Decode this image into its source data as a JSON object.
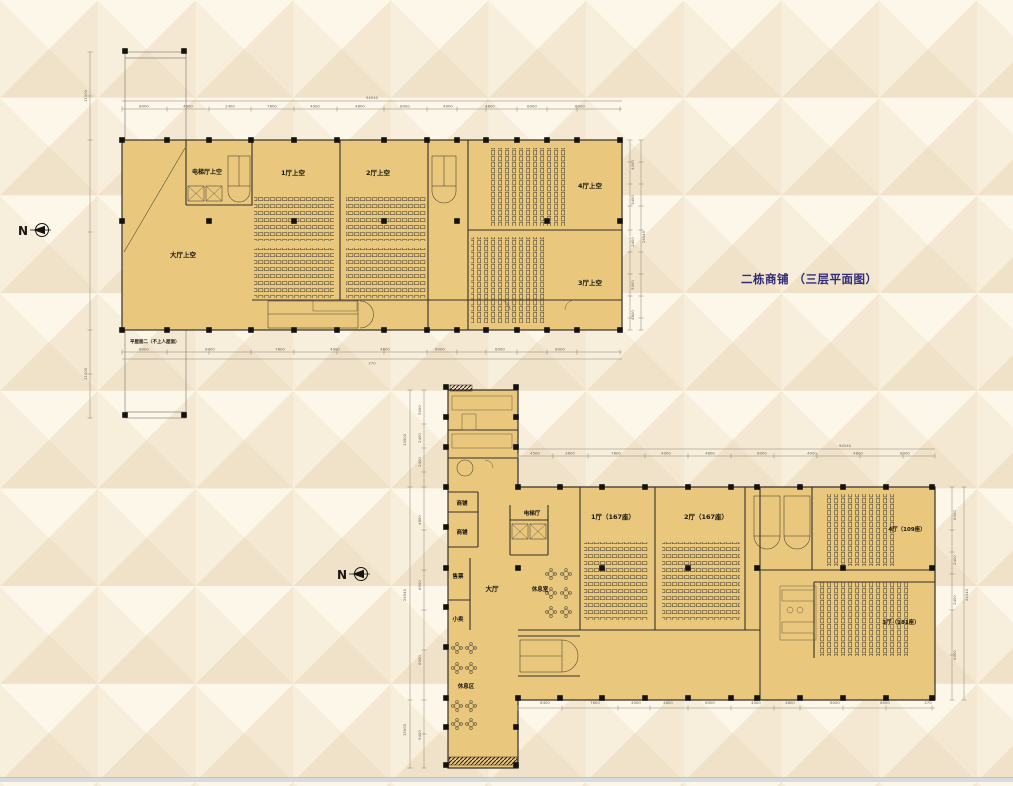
{
  "title": "二栋商铺 （三层平面图）",
  "compass": {
    "label": "N"
  },
  "plan_upper": {
    "rooms": {
      "lobby": "大厅上空",
      "elevator_hall": "电梯厅上空",
      "hall1": "1厅上空",
      "hall2": "2厅上空",
      "hall3": "3厅上空",
      "hall4": "4厅上空"
    },
    "note": "平屋面二（不上人屋面）",
    "dims": {
      "overall_width": "94540",
      "overall_height": "24540",
      "top": [
        "270",
        "8000",
        "4800",
        "2400",
        "7600",
        "4000",
        "4800",
        "8000",
        "4000",
        "4800",
        "8000",
        "8000",
        "270"
      ],
      "bottom": [
        "270",
        "8000",
        "8400",
        "7600",
        "4000",
        "4800",
        "8000",
        "8000",
        "8000",
        "8000",
        "270"
      ],
      "right": [
        "4000",
        "3400",
        "3000",
        "2400",
        "5000",
        "4800"
      ],
      "left": [
        "11000",
        "11000"
      ]
    }
  },
  "plan_lower": {
    "rooms": {
      "lobby": "大厅",
      "elevator_hall": "电梯厅",
      "shop_a": "商铺",
      "shop_b": "商铺",
      "ticket": "售票",
      "kiosk": "小卖",
      "lounge": "休息室",
      "rest_area": "休息区",
      "hall1": "1厅（167座）",
      "hall2": "2厅（167座）",
      "hall3": "3厅（181座）",
      "hall4": "4厅（109座）"
    },
    "dims": {
      "overall_width": "94540",
      "overall_height": "24540",
      "top": [
        "4500",
        "3600",
        "7600",
        "4000",
        "4800",
        "8000",
        "4000",
        "4800",
        "8000"
      ],
      "bottom": [
        "8400",
        "7600",
        "4000",
        "4800",
        "8000",
        "4000",
        "4800",
        "8000",
        "8000",
        "270"
      ],
      "left_segments": [
        "5000",
        "2400",
        "2400",
        "2400",
        "5000",
        "4800",
        "6000",
        "8000",
        "2400",
        "5400"
      ],
      "left_totals": [
        "13900",
        "24540",
        "15000"
      ],
      "right": [
        "6000",
        "2400",
        "2400",
        "2400",
        "6000"
      ]
    }
  }
}
